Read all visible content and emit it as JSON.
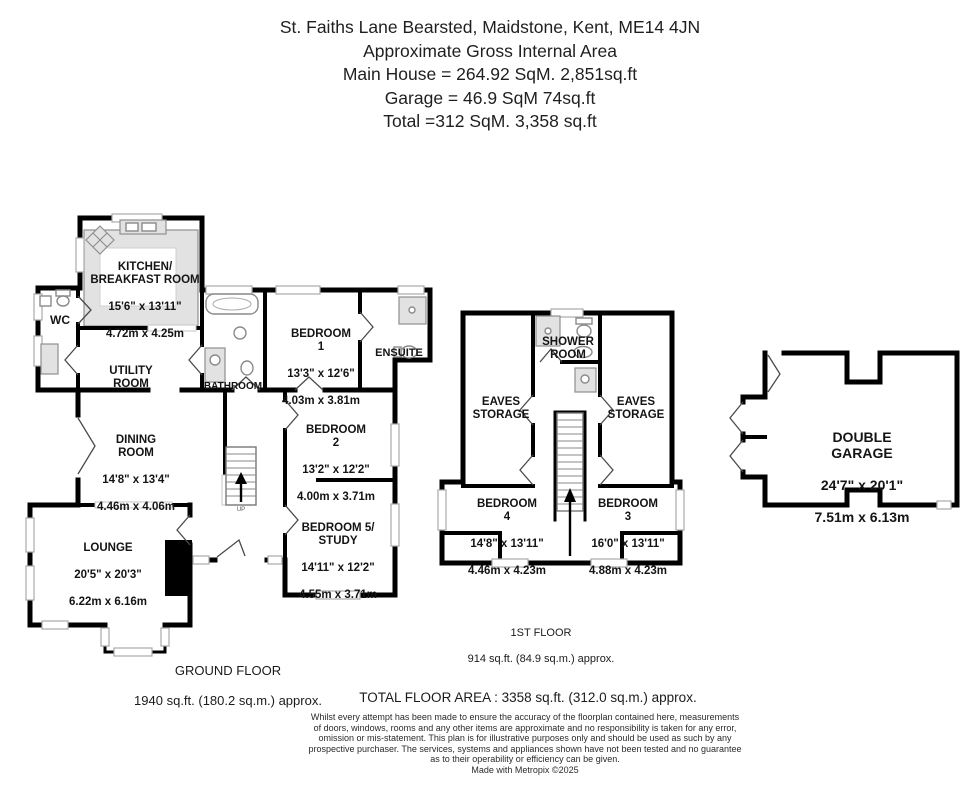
{
  "header": {
    "address": "St. Faiths Lane  Bearsted, Maidstone, Kent, ME14 4JN",
    "subtitle": "Approximate Gross Internal Area",
    "main_house": "Main House = 264.92 SqM. 2,851sq.ft",
    "garage_line": "Garage = 46.9 SqM 74sq.ft",
    "total_line": "Total =312 SqM. 3,358 sq.ft"
  },
  "floorplan": {
    "ground_floor": {
      "caption": "GROUND FLOOR",
      "area": "1940 sq.ft. (180.2 sq.m.) approx.",
      "stairs_label": "UP",
      "rooms": {
        "kitchen": {
          "name": "KITCHEN/\nBREAKFAST ROOM",
          "imperial": "15'6\"  x 13'11\"",
          "metric": "4.72m  x 4.25m"
        },
        "wc": {
          "name": "WC"
        },
        "utility": {
          "name": "UTILITY\nROOM"
        },
        "bathroom": {
          "name": "BATHROOM"
        },
        "bedroom1": {
          "name": "BEDROOM\n1",
          "imperial": "13'3\"  x 12'6\"",
          "metric": "4.03m  x 3.81m"
        },
        "ensuite": {
          "name": "ENSUITE"
        },
        "dining": {
          "name": "DINING\nROOM",
          "imperial": "14'8\"  x 13'4\"",
          "metric": "4.46m  x 4.06m"
        },
        "bedroom2": {
          "name": "BEDROOM\n2",
          "imperial": "13'2\"  x 12'2\"",
          "metric": "4.00m  x 3.71m"
        },
        "lounge": {
          "name": "LOUNGE",
          "imperial": "20'5\"  x 20'3\"",
          "metric": "6.22m  x 6.16m"
        },
        "bedroom5": {
          "name": "BEDROOM 5/\nSTUDY",
          "imperial": "14'11\"  x 12'2\"",
          "metric": "4.55m  x 3.71m"
        }
      }
    },
    "first_floor": {
      "caption": "1ST FLOOR",
      "area": "914 sq.ft. (84.9 sq.m.) approx.",
      "rooms": {
        "shower": {
          "name": "SHOWER\nROOM"
        },
        "eaves_left": {
          "name": "EAVES\nSTORAGE"
        },
        "eaves_right": {
          "name": "EAVES\nSTORAGE"
        },
        "bedroom4": {
          "name": "BEDROOM\n4",
          "imperial": "14'8\"  x 13'11\"",
          "metric": "4.46m  x 4.23m"
        },
        "bedroom3": {
          "name": "BEDROOM\n3",
          "imperial": "16'0\"  x 13'11\"",
          "metric": "4.88m  x 4.23m"
        }
      }
    },
    "garage": {
      "rooms": {
        "double_garage": {
          "name": "DOUBLE GARAGE",
          "imperial": "24'7\"  x 20'1\"",
          "metric": "7.51m  x 6.13m"
        }
      }
    }
  },
  "footer": {
    "total_area": "TOTAL FLOOR AREA : 3358 sq.ft. (312.0 sq.m.) approx.",
    "disclaimer": "Whilst every attempt has been made to ensure the accuracy of the floorplan contained here, measurements\nof doors, windows, rooms and any other items are approximate and no responsibility is taken for any error,\nomission or mis-statement. This plan is for illustrative purposes only and should be used as such by any\nprospective purchaser. The services, systems and appliances shown have not been tested and no guarantee\nas to their operability or efficiency can be given.\nMade with Metropix ©2025"
  },
  "colors": {
    "wall": "#000000",
    "shading": "#e2e2e2",
    "window_outline": "#a9a9a9",
    "text": "#141414",
    "background": "#ffffff"
  }
}
